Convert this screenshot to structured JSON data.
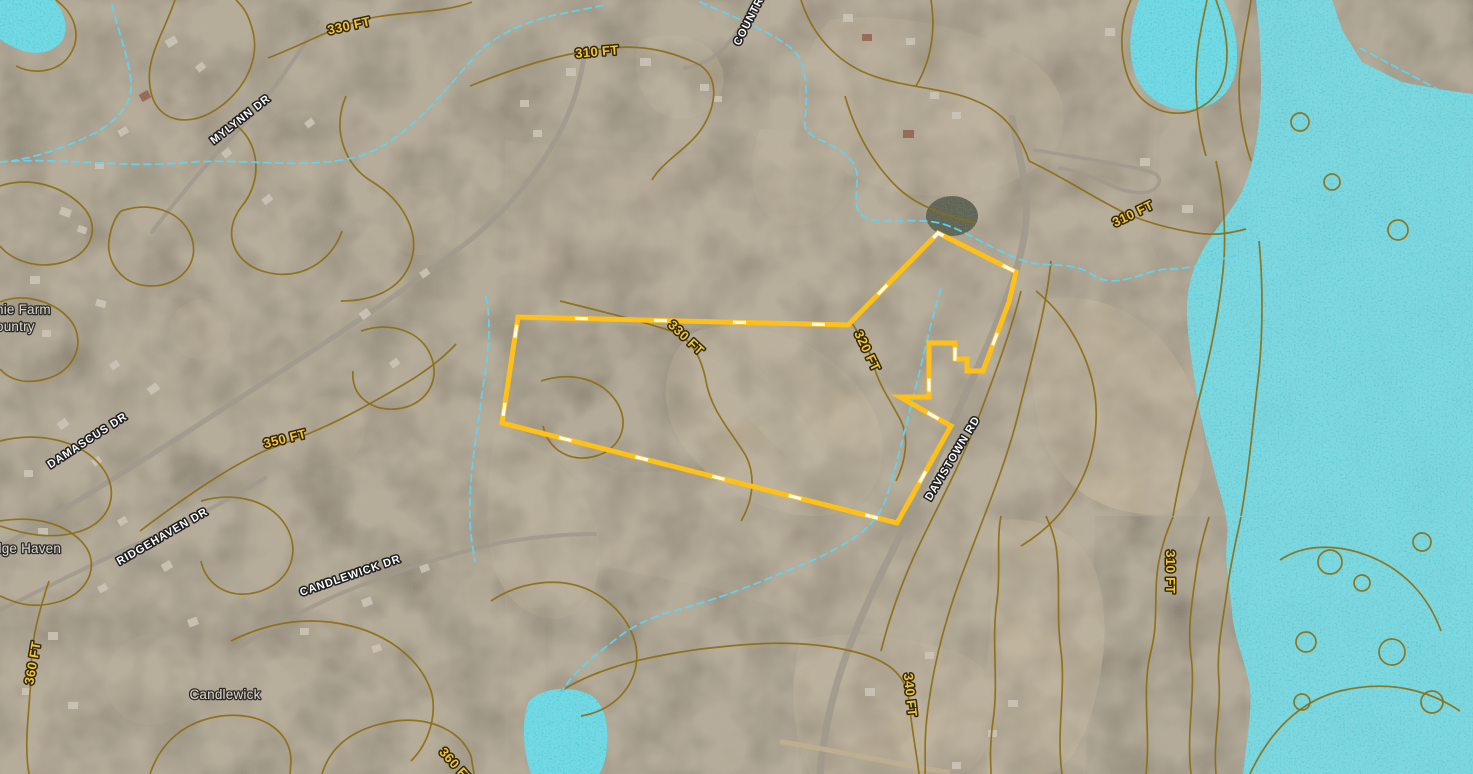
{
  "overlays": {
    "contour_labels": [
      {
        "text": "330 FT"
      },
      {
        "text": "310 FT"
      },
      {
        "text": "310 FT"
      },
      {
        "text": "350 FT"
      },
      {
        "text": "330 FT"
      },
      {
        "text": "320 FT"
      },
      {
        "text": "360 FT"
      },
      {
        "text": "340 FT"
      },
      {
        "text": "310 FT"
      },
      {
        "text": "360 FT"
      }
    ],
    "street_labels": [
      {
        "text": "MYLYNN DR"
      },
      {
        "text": "COUNTR"
      },
      {
        "text": "DAMASCUS DR"
      },
      {
        "text": "RIDGEHAVEN DR"
      },
      {
        "text": "CANDLEWICK DR"
      },
      {
        "text": "DAVISTOWN RD"
      }
    ],
    "place_labels": [
      {
        "text": "nie Farm"
      },
      {
        "text": "ountry"
      },
      {
        "text": "dge Haven"
      },
      {
        "text": "Candlewick"
      }
    ],
    "colors": {
      "parcel_outline": "#ffc117",
      "parcel_tick": "#ffffff",
      "contour_line": "#8c6e14",
      "contour_label": "#f2c63c",
      "stream": "#5fd4f2",
      "flood_zone": "#2cc4d4",
      "street_label": "#ffffff",
      "place_label": "#e0ddd8"
    }
  }
}
